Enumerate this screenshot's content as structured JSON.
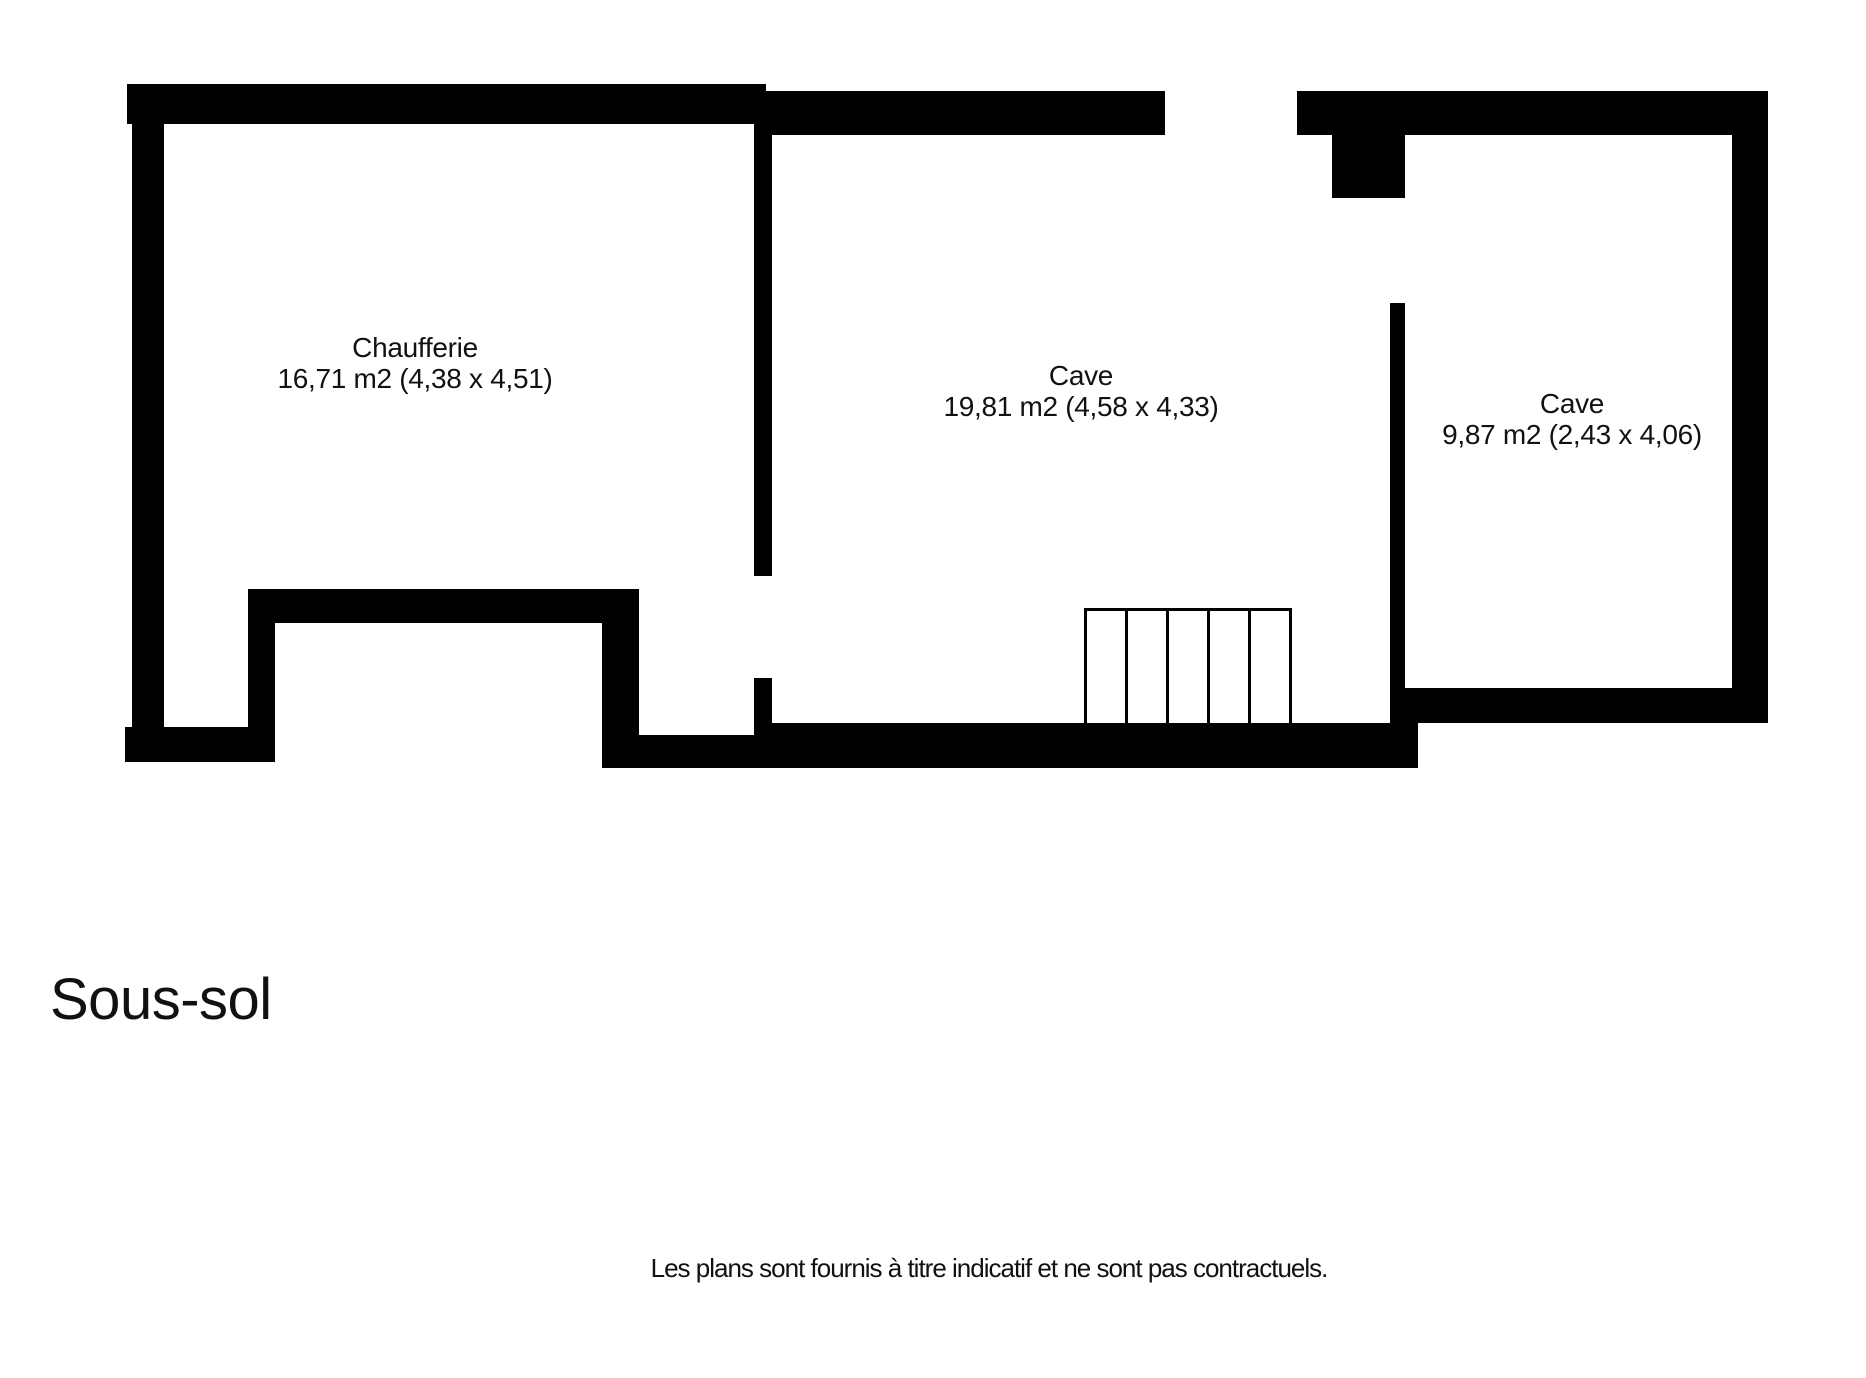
{
  "floor_plan": {
    "title": "Sous-sol",
    "disclaimer": "Les plans sont fournis à titre indicatif et ne sont pas contractuels.",
    "rooms": [
      {
        "name": "Chaufferie",
        "size_label": "16,71 m2 (4,38 x 4,51)"
      },
      {
        "name": "Cave",
        "size_label": "19,81 m2 (4,58 x 4,33)"
      },
      {
        "name": "Cave",
        "size_label": "9,87 m2 (2,43 x 4,06)"
      }
    ],
    "stairs": {
      "steps": 5
    },
    "colors": {
      "wall": "#000000",
      "background": "#ffffff",
      "text": "#111111"
    }
  }
}
